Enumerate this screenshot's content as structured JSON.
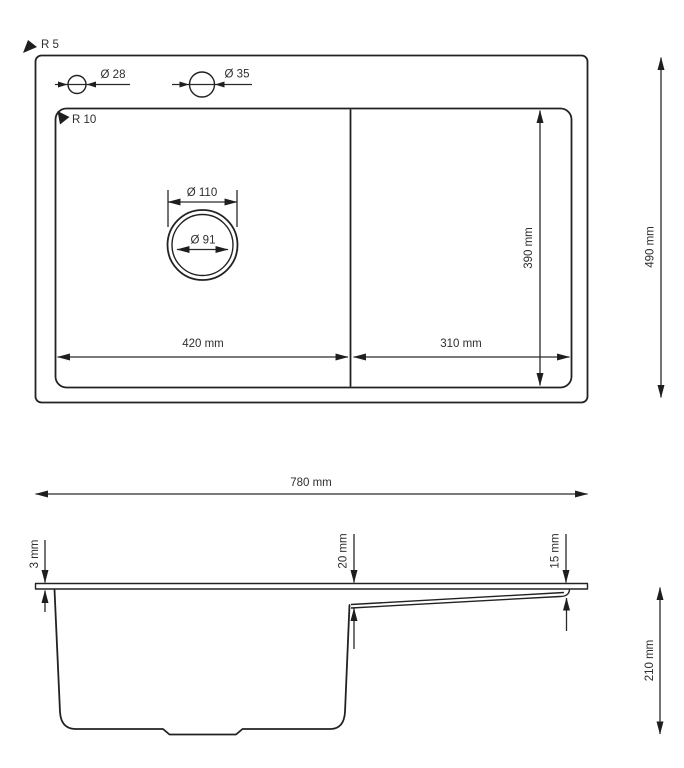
{
  "drawing": {
    "description": "Kitchen sink technical drawing with top view and side section view",
    "colors": {
      "line": "#222222",
      "dimension_line": "#2a2a2a",
      "text": "#2e2e2e",
      "background": "#ffffff"
    },
    "top_view": {
      "outer_corner_radius": "R 5",
      "inner_corner_radius": "R 10",
      "tap_hole_small_diameter": "Ø 28",
      "tap_hole_large_diameter": "Ø 35",
      "drain_outer_diameter": "Ø 110",
      "drain_inner_diameter": "Ø 91",
      "bowl_width": "420 mm",
      "drainboard_width": "310 mm",
      "inner_depth": "390 mm",
      "overall_depth": "490 mm"
    },
    "side_view": {
      "overall_width": "780 mm",
      "rim_thickness": "3 mm",
      "ledge_drop_bowl_side": "20 mm",
      "ledge_drop_outer_side": "15 mm",
      "bowl_height": "210 mm"
    }
  }
}
